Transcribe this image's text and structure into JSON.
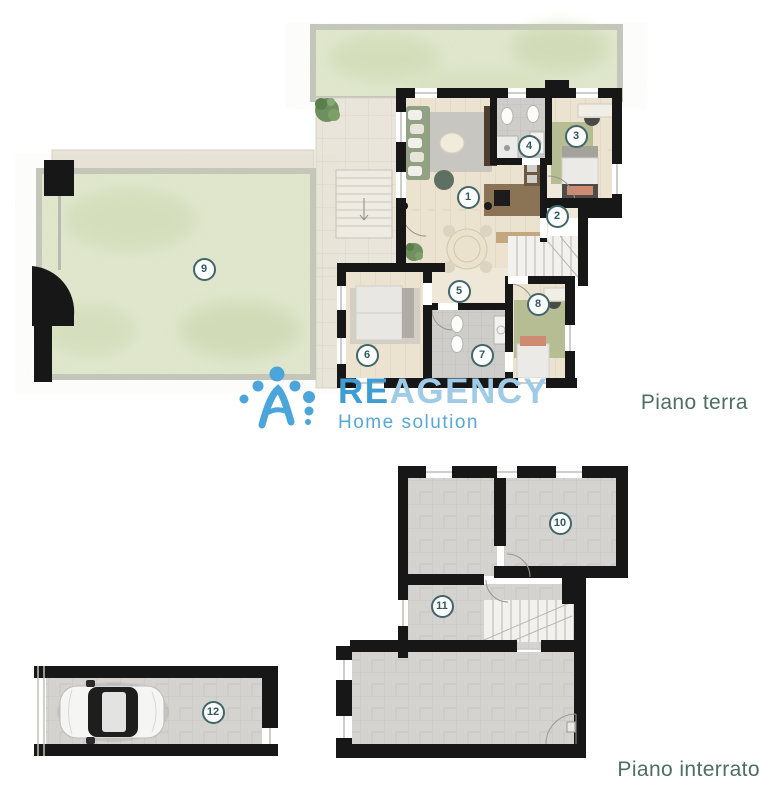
{
  "branding": {
    "logo_primary": "RE",
    "logo_secondary": "AGENCY",
    "logo_subtitle": "Home solution"
  },
  "floor_labels": {
    "ground": "Piano terra",
    "basement": "Piano interrato"
  },
  "room_markers": [
    {
      "number": "1",
      "floor": "Piano terra",
      "x": 468,
      "y": 197
    },
    {
      "number": "2",
      "floor": "Piano terra",
      "x": 557,
      "y": 216
    },
    {
      "number": "3",
      "floor": "Piano terra",
      "x": 576,
      "y": 136
    },
    {
      "number": "4",
      "floor": "Piano terra",
      "x": 529,
      "y": 146
    },
    {
      "number": "5",
      "floor": "Piano terra",
      "x": 459,
      "y": 291
    },
    {
      "number": "6",
      "floor": "Piano terra",
      "x": 367,
      "y": 355
    },
    {
      "number": "7",
      "floor": "Piano terra",
      "x": 482,
      "y": 355
    },
    {
      "number": "8",
      "floor": "Piano terra",
      "x": 538,
      "y": 304
    },
    {
      "number": "9",
      "floor": "Piano terra",
      "x": 204,
      "y": 269
    },
    {
      "number": "10",
      "floor": "Piano interrato",
      "x": 560,
      "y": 523
    },
    {
      "number": "11",
      "floor": "Piano interrato",
      "x": 442,
      "y": 606
    },
    {
      "number": "12",
      "floor": "Piano interrato",
      "x": 213,
      "y": 712
    }
  ],
  "colors": {
    "logo_blue": "#3d9ed5",
    "logo_blue_light": "#9fcbe7",
    "logo_sub": "#56a9d6",
    "label_teal": "#4e6e63",
    "marker_border": "#40666c",
    "marker_text": "#2f5a63",
    "wall_black": "#171717",
    "garden_green": "#e0e7cd",
    "wood_floor": "#ebe2d0",
    "cellar_gray": "#d5d3cf"
  }
}
